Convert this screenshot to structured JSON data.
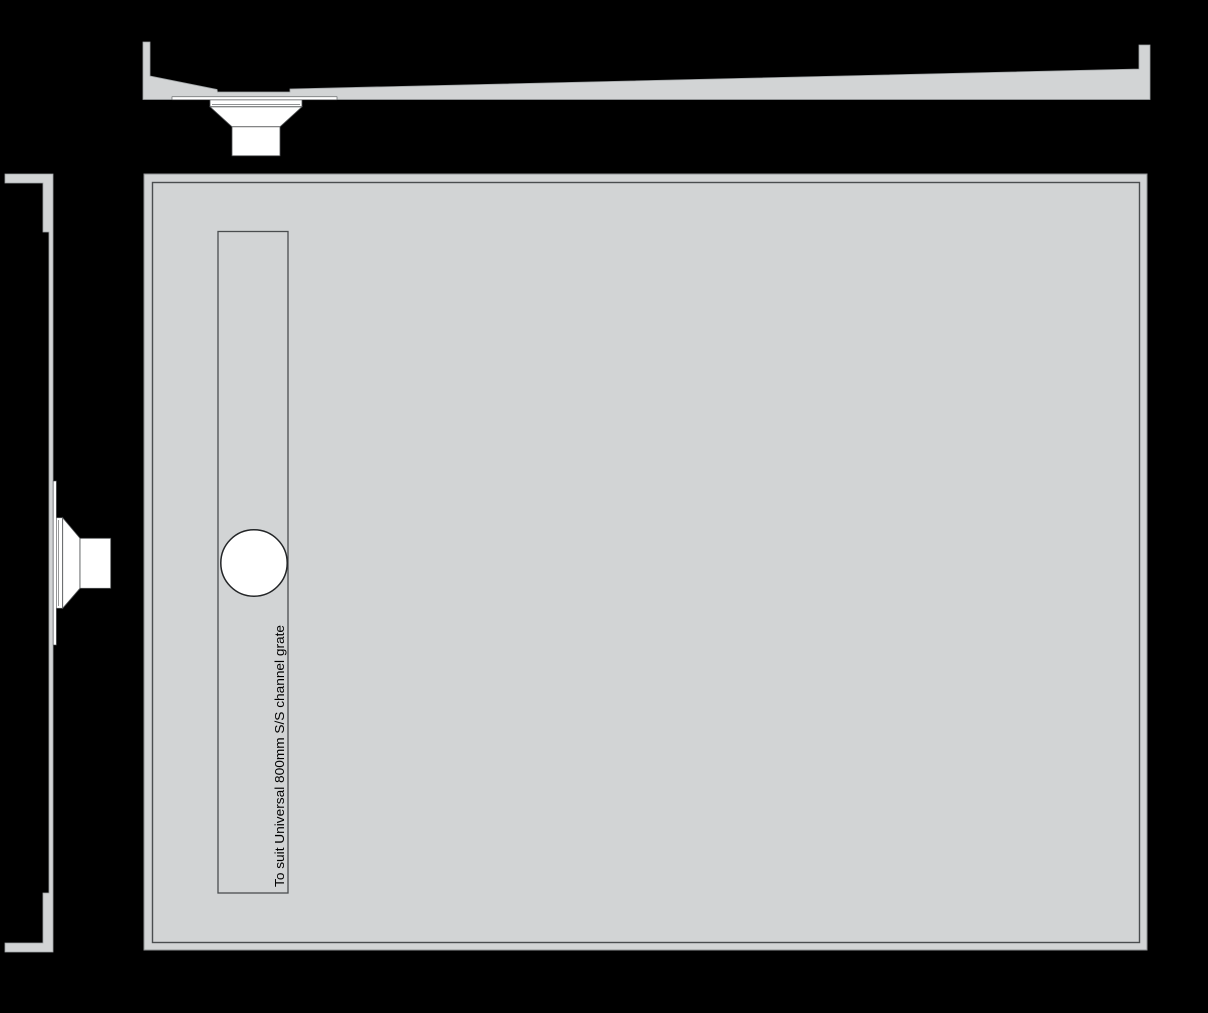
{
  "colors": {
    "background": "#000000",
    "tray_fill": "#d2d4d5",
    "tray_edge": "#9fa3a5",
    "panel_edge": "#8f9294",
    "inner_line": "#4a4d4f",
    "circle_stroke": "#232527",
    "fitting_fill": "#ffffff",
    "fitting_stroke": "#4f5254",
    "label_color": "#000000"
  },
  "plan": {
    "channel_label": "To suit Universal 800mm S/S channel grate"
  }
}
